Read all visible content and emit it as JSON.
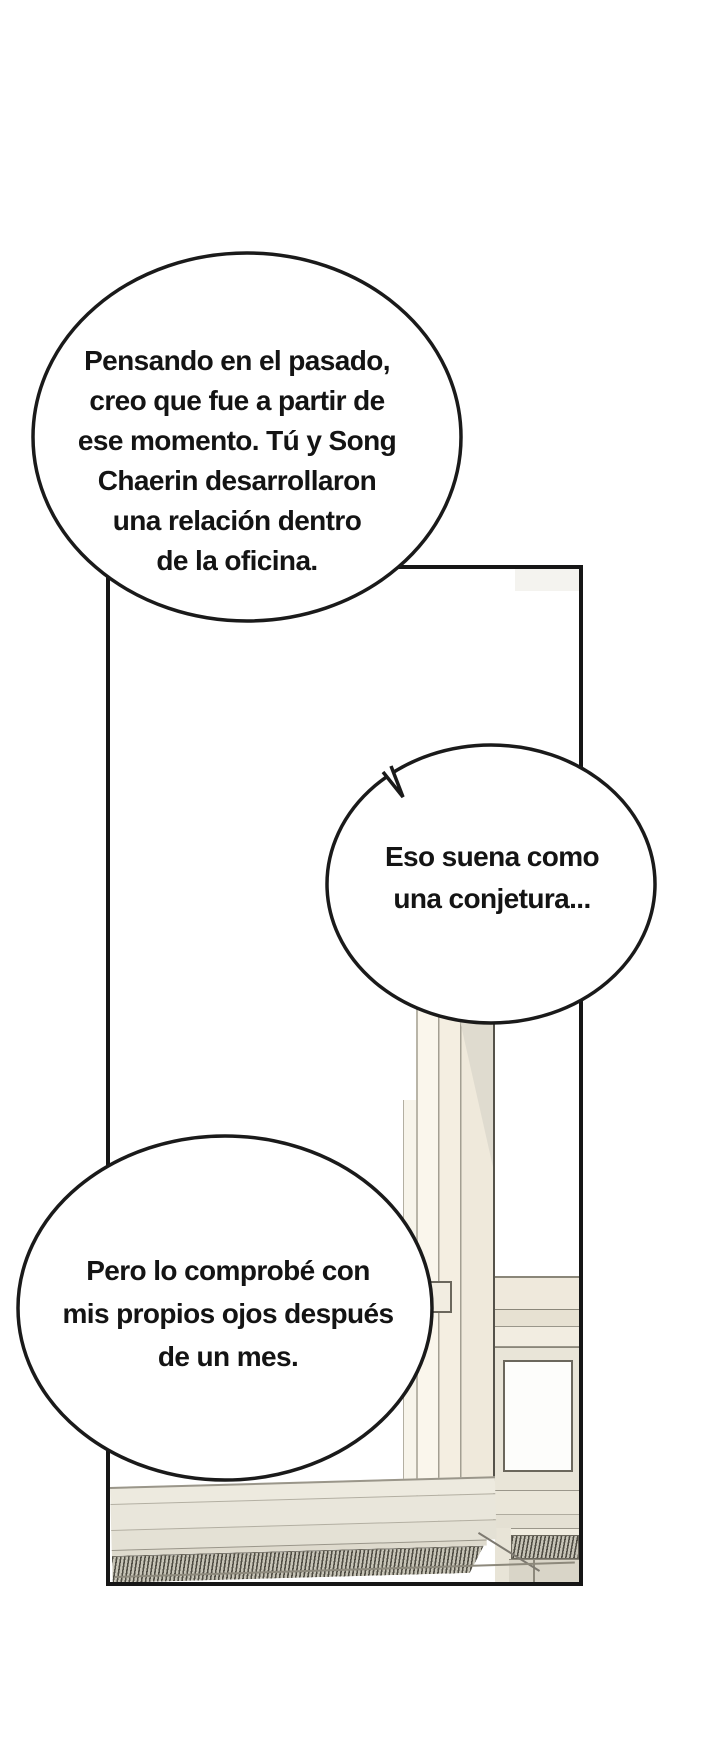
{
  "page": {
    "kind": "webtoon comic page",
    "width": 720,
    "height": 1750,
    "background": "#ffffff"
  },
  "panel": {
    "description": "office interior window with sill and floor heater grilles",
    "border_color": "#161616"
  },
  "dialogue": {
    "bubble1": {
      "lines": [
        "Pensando en el pasado,",
        "creo que fue a partir de",
        "ese momento. Tú y Song",
        "Chaerin desarrollaron",
        "una relación dentro",
        "de la oficina."
      ]
    },
    "bubble2": {
      "lines": [
        "Eso suena como",
        "una conjetura..."
      ]
    },
    "bubble3": {
      "lines": [
        "Pero lo comprobé con",
        "mis propios ojos después",
        "de un mes."
      ]
    }
  },
  "colors": {
    "ink": "#161616",
    "frame_light": "#faf6ec",
    "frame_mid": "#efe9db",
    "frame_shadow": "#dcd8cd",
    "outline": "#8d897c",
    "radiator_dark": "#4f4c43",
    "radiator_light": "#c6c3b6"
  }
}
